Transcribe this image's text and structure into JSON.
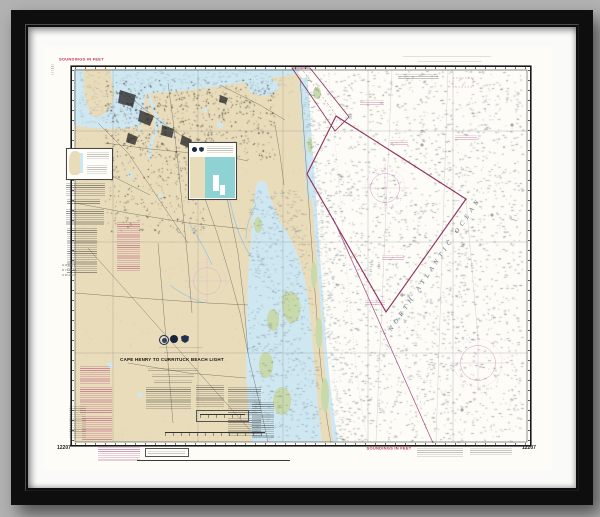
{
  "labels": {
    "soundings_top": "SOUNDINGS IN FEET",
    "soundings_bottom": "SOUNDINGS IN FEET",
    "title": "CAPE HENRY TO CURRITUCK BEACH LIGHT",
    "chart_number_bottom_left": "12207",
    "chart_number_bottom_right": "12207",
    "ocean_name": "NORTH ATLANTIC OCEAN",
    "swamp_line1": "GREAT",
    "swamp_line2": "DISMAL",
    "swamp_line3": "SWAMP"
  },
  "colors": {
    "background": "#b2b2b2",
    "frame": "#0e0e0e",
    "mat": "#fafaf8",
    "paper": "#fdfcf7",
    "land": "#e9dcba",
    "water": "#cfe7f0",
    "shallow": "#c6e4f2",
    "marsh": "#c8d9ab",
    "inset_water": "#8fd2d3",
    "magenta": "#8e2c5e",
    "magenta_light": "#c77bb0",
    "soundings_text": "#c03050",
    "urban": "#2e2e2e"
  }
}
